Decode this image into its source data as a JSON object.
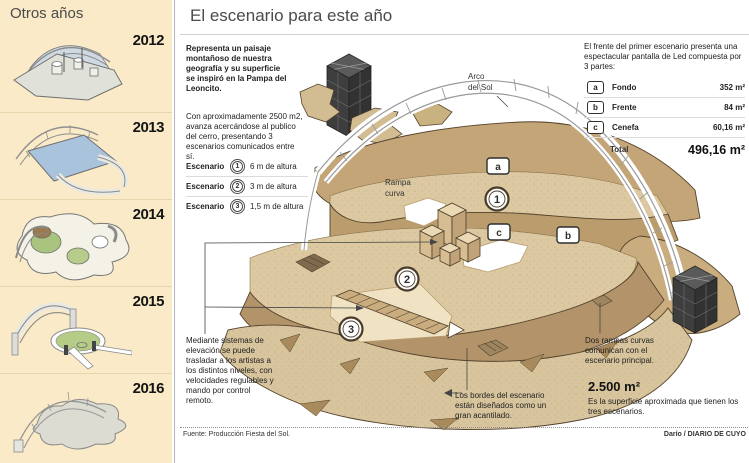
{
  "sidebar": {
    "title": "Otros años",
    "years": [
      "2012",
      "2013",
      "2014",
      "2015",
      "2016"
    ]
  },
  "header": {
    "title": "El escenario para este año"
  },
  "intro": {
    "p1": "Representa un paisaje montañoso de nuestra geografía y su superficie se inspiró en la Pampa del Leoncito.",
    "p2": "Con aproximadamente 2500 m2, avanza acercándose al publico del cerro, presentando 3 escenarios comunicados entre sí."
  },
  "stages": {
    "label": "Escenario",
    "items": [
      {
        "num": "1",
        "desc": "6 m de altura"
      },
      {
        "num": "2",
        "desc": "3 m de altura"
      },
      {
        "num": "3",
        "desc": "1,5 m de altura"
      }
    ]
  },
  "led": {
    "intro": "El frente del primer escenario presenta una espectacular pantalla de Led compuesta por 3 partes:",
    "rows": [
      {
        "key": "a",
        "name": "Fondo",
        "value": "352 m²"
      },
      {
        "key": "b",
        "name": "Frente",
        "value": "84 m²"
      },
      {
        "key": "c",
        "name": "Cenefa",
        "value": "60,16 m²"
      }
    ],
    "total_label": "Total",
    "total_value": "496,16 m²"
  },
  "diagram": {
    "arco_line1": "Arco",
    "arco_line2": "del Sol",
    "rampa_line1": "Rampa",
    "rampa_line2": "curva",
    "markers": {
      "a": "a",
      "b": "b",
      "c": "c",
      "n1": "1",
      "n2": "2",
      "n3": "3"
    }
  },
  "notes": {
    "elevation": "Mediante sistemas de elevación se puede trasladar a los artistas a los distintos niveles, con velocidades regulables y mando por control remoto.",
    "borders": "Los bordes del escenario están diseñados como un gran acantilado.",
    "ramps": "Dos rampas curvas comunican con el escenario principal.",
    "area_value": "2.500 m²",
    "area_desc": "Es la superficie aproximada que tienen los tres escenarios."
  },
  "footer": {
    "source": "Fuente: Producción Fiesta del Sol.",
    "credit": "Darío / DIARIO DE CUYO"
  },
  "colors": {
    "sidebar_bg": "#faeac7",
    "terrain_light": "#dcc9a2",
    "terrain_dark": "#bb9c6d",
    "terrain_outline": "#54422c",
    "tower_dark": "#3c3c3c",
    "arch_gray": "#9a9a9a"
  }
}
